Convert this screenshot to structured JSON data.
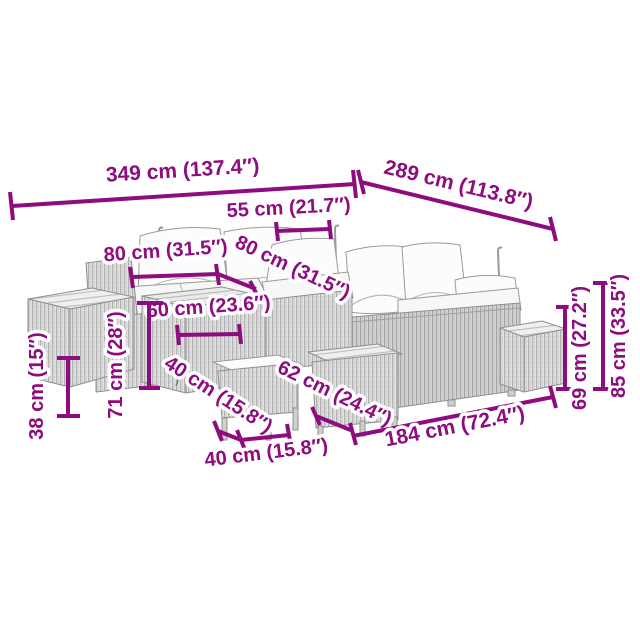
{
  "diagram": {
    "kind": "product-dimension-diagram",
    "subject": "garden-lounge-furniture-set-line-drawing",
    "background_color": "#ffffff",
    "accent_color": "#8E0C7D",
    "dimensions": [
      {
        "id": "overall-width-left",
        "cm": 349,
        "inches": 137.4,
        "label": "349 cm (137.4″)"
      },
      {
        "id": "overall-depth-right",
        "cm": 289,
        "inches": 113.8,
        "label": "289 cm (113.8″)"
      },
      {
        "id": "back-cushion-width",
        "cm": 55,
        "inches": 21.7,
        "label": "55 cm (21.7″)"
      },
      {
        "id": "section-width-left",
        "cm": 80,
        "inches": 31.5,
        "label": "80 cm (31.5″)"
      },
      {
        "id": "section-depth-corner",
        "cm": 80,
        "inches": 31.5,
        "label": "80 cm (31.5″)"
      },
      {
        "id": "table-width",
        "cm": 60,
        "inches": 23.6,
        "label": "60 cm (23.6″)"
      },
      {
        "id": "sofa-height",
        "cm": 71,
        "inches": 28,
        "label": "71 cm (28″)"
      },
      {
        "id": "side-table-height",
        "cm": 38,
        "inches": 15,
        "label": "38 cm (15″)"
      },
      {
        "id": "stool-depth",
        "cm": 40,
        "inches": 15.8,
        "label": "40 cm (15.8″)"
      },
      {
        "id": "ottoman-depth",
        "cm": 62,
        "inches": 24.4,
        "label": "62 cm (24.4″)"
      },
      {
        "id": "stool-width",
        "cm": 40,
        "inches": 15.8,
        "label": "40 cm (15.8″)"
      },
      {
        "id": "sofa-length",
        "cm": 184,
        "inches": 72.4,
        "label": "184 cm (72.4″)"
      },
      {
        "id": "backrest-height",
        "cm": 69,
        "inches": 27.2,
        "label": "69 cm (27.2″)"
      },
      {
        "id": "total-height",
        "cm": 85,
        "inches": 33.5,
        "label": "85 cm (33.5″)"
      }
    ]
  }
}
